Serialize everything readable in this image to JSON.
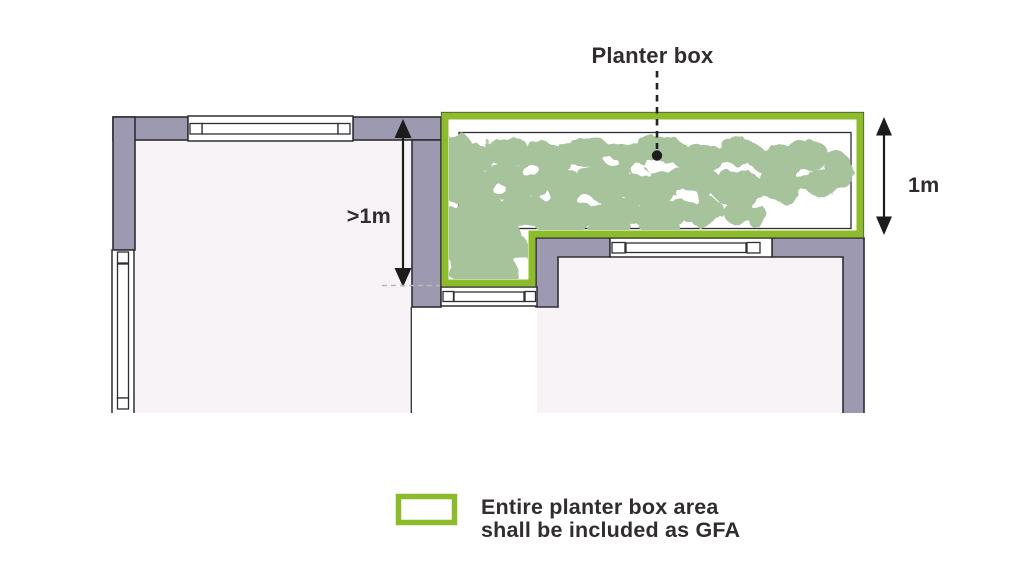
{
  "diagram": {
    "title": "Planter box",
    "dimension_labels": {
      "offset_from_wall": ">1m",
      "planter_depth": "1m"
    },
    "legend": {
      "lines": [
        "Entire planter box area",
        "shall be included as GFA"
      ]
    },
    "colors": {
      "accent_green": "#8cbc2b",
      "foliage": "#a7c39c",
      "wall": "#9c99b0",
      "interior": "#f7f3f6",
      "outline": "#2f2e33",
      "text": "#312d2e",
      "level_dash": "#b9b9b9",
      "background": "#ffffff"
    }
  }
}
